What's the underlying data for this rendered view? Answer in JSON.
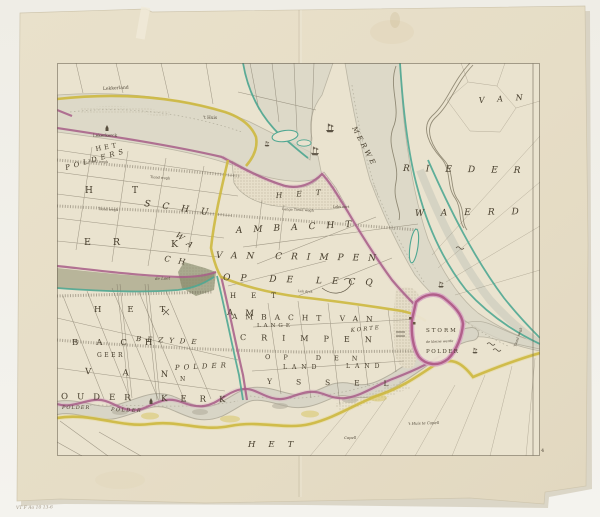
{
  "palette": {
    "background": "#f1efe9",
    "paper": "#e6ddc7",
    "plate": "#eae3cf",
    "water": "#d8d5c6",
    "boundary_magenta": "#a75d87",
    "dike_yellow": "#cdb83f",
    "bank_teal": "#4fa792",
    "marsh_olive": "#8e9070",
    "ink": "#453c2b"
  },
  "labels": {
    "lekkerland": "Lekkerland",
    "lekerkerck": "Lekerkerck",
    "thuis": "'t Huis",
    "nw_het": "HET",
    "nw_polders": "POLDERS",
    "nw_h": "H",
    "nw_t": "T",
    "nw_schu": "SCHU",
    "nw_wa": "WA",
    "nw_ch": "CH",
    "nw_er": "ER",
    "nw_k": "K",
    "c_het": "HET",
    "ambacht": "AMBACHT",
    "van_crimpen": "VAN CRIMPEN",
    "op_de_lecq": "OP DE LECQ",
    "c_het2": "HET",
    "ambacht_van": "AMBACHT VAN",
    "lange": "LANGE",
    "crimpen": "CRIMPEN",
    "korte": "KORTE",
    "op_den": "OP DEN",
    "land1": "LAND",
    "land2": "LAND",
    "yssel": "YSSEL",
    "storm": "STORM",
    "storm_note": "de kleine werde",
    "storm_polder": "POLDER",
    "w_het": "HET",
    "w_am": "AM",
    "w_bach": "BACH",
    "w_geer": "GEER",
    "w_bezyde": "BEZYDE",
    "w_van": "VAN",
    "w_polder": "POLDER",
    "w_n": "N",
    "ouder": "OUDER",
    "kerk": "KERK",
    "polder_it1": "POLDER",
    "polder_it2": "POLDER",
    "s_het": "HET",
    "de_loet": "de Loet",
    "ne_van": "VAN",
    "rieder": "RIEDER",
    "waerd": "WAERD",
    "merwe": "MERWE",
    "tiend_r": "Tiend wegh",
    "lange_tiend": "Lange Tiend wegh",
    "leks_oort": "Leks oort",
    "lekdyk": "Lek dyck",
    "tiend1": "Tiend wegh",
    "tiend2": "Tiend wegh",
    "tiend3": "Tiend wegh",
    "capell_huis": "'t Huis te Capell",
    "capell": "Capell"
  },
  "marginalia": {
    "inscription": "VT F Ao 10 13-6",
    "folio": "4"
  }
}
